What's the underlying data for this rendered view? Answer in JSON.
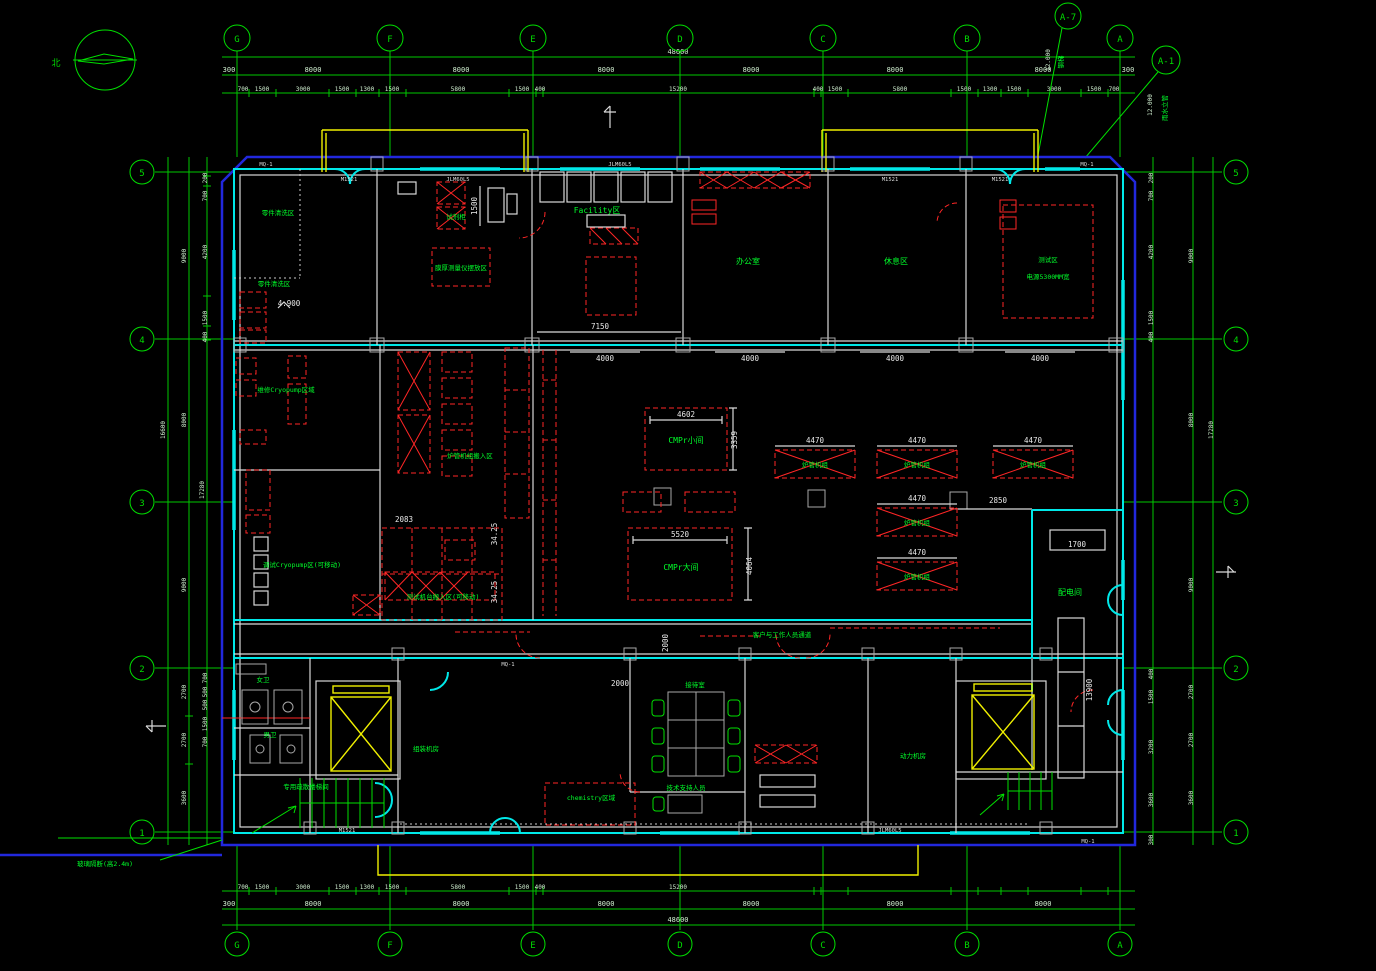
{
  "compass": {
    "north": "北"
  },
  "grid": {
    "cols": [
      "G",
      "F",
      "E",
      "D",
      "C",
      "B",
      "A"
    ],
    "rows": [
      "5",
      "4",
      "3",
      "2",
      "1"
    ],
    "ref1": "A-7",
    "ref2": "A-1"
  },
  "dims": {
    "overall": "48600",
    "bay": "8000",
    "edge": "300",
    "top_minor": [
      "700",
      "1500",
      "3000",
      "1500",
      "1300",
      "1500",
      "5800",
      "1500",
      "400",
      "15200",
      "400",
      "1500",
      "5800",
      "1500",
      "1300",
      "1500",
      "3000",
      "1500",
      "700"
    ],
    "left_major": [
      "9000",
      "8000",
      "9000",
      "2700",
      "2700",
      "3600"
    ],
    "left_total_a": "16600",
    "left_total_b": "17280",
    "left_minor": [
      "200",
      "700",
      "4200",
      "1500",
      "400"
    ],
    "left_minor_low": [
      "700",
      "500",
      "500",
      "1500",
      "700"
    ],
    "right_minor_low": [
      "400",
      "1500",
      "3200",
      "3600",
      "300"
    ]
  },
  "callouts": {
    "c1a": "12.000",
    "c1b": "钢梯",
    "c2a": "12.000",
    "c2b": "雨水立管"
  },
  "rooms": {
    "parts_cleaning": "零件清洗区",
    "cryo_repair": "维修Cryopump区域",
    "cryo_debug": "调试Cryopump区(可移动)",
    "test_movein": "测试机台搬入区(可移动)",
    "tube_movein": "炉管机组搬入区",
    "cmp_small": "CMPr小间",
    "cmp_large": "CMPr大间",
    "tube_unit": "炉管机组",
    "facility": "Facility区",
    "reagent": "试剂柜",
    "film": "膜厚测量仪摆放区",
    "office": "办公室",
    "lounge": "休息区",
    "test1": "测试区",
    "test2": "电源5300MM宽",
    "power": "配电间",
    "wc_w": "女卫",
    "wc_m": "男卫",
    "reception": "接待室",
    "tech": "技术支持人员",
    "corridor": "客户与工作人员通道",
    "assembly": "组装机房",
    "plant": "动力机房",
    "chem": "chemistry区域",
    "stair": "专用疏散楼梯间",
    "glass": "玻璃隔断(高2.4m)"
  },
  "plan_dims": {
    "cmp_s_w": "4602",
    "cmp_s_h": "3359",
    "cmp_l_w": "5520",
    "cmp_l_h": "4064",
    "tube": "4470",
    "tube_off": "2850",
    "fac": "7150",
    "win": "4000",
    "pd_a": "1700",
    "pd_b": "13900",
    "shelf": "1500",
    "cor_v": "2000",
    "cor_h": "2000",
    "misc": "2083",
    "rack": "34.25",
    "level": "4.900"
  },
  "wall_tags": {
    "mq1": "MQ-1",
    "m1521": "M1521",
    "jlm": "JLM60L5"
  }
}
